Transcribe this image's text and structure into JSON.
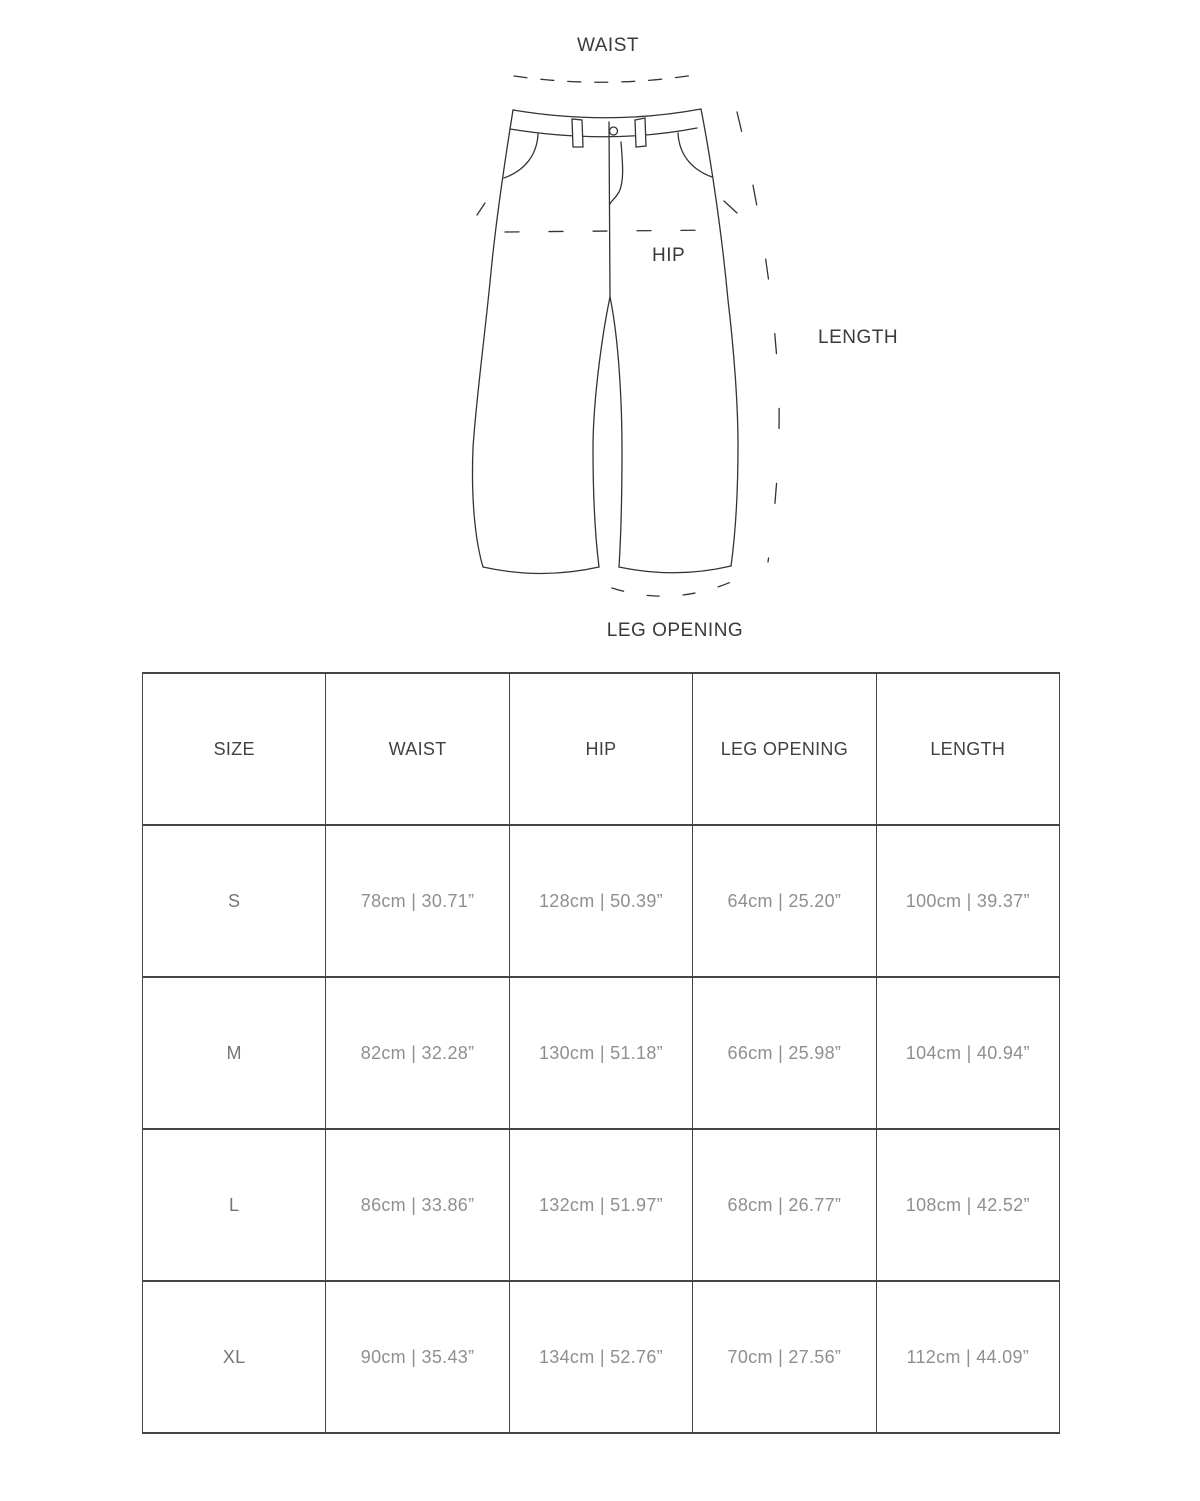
{
  "diagram": {
    "labels": {
      "waist": "WAIST",
      "hip": "HIP",
      "length": "LENGTH",
      "leg_opening": "LEG OPENING"
    }
  },
  "table": {
    "headers": [
      "SIZE",
      "WAIST",
      "HIP",
      "LEG OPENING",
      "LENGTH"
    ],
    "rows": [
      {
        "size": "S",
        "waist": "78cm | 30.71”",
        "hip": "128cm | 50.39”",
        "leg_opening": "64cm | 25.20”",
        "length": "100cm | 39.37”"
      },
      {
        "size": "M",
        "waist": "82cm | 32.28”",
        "hip": "130cm | 51.18”",
        "leg_opening": "66cm | 25.98”",
        "length": "104cm | 40.94”"
      },
      {
        "size": "L",
        "waist": "86cm | 33.86”",
        "hip": "132cm | 51.97”",
        "leg_opening": "68cm | 26.77”",
        "length": "108cm | 42.52”"
      },
      {
        "size": "XL",
        "waist": "90cm | 35.43”",
        "hip": "134cm | 52.76”",
        "leg_opening": "70cm | 27.56”",
        "length": "112cm | 44.09”"
      }
    ]
  },
  "colors": {
    "background": "#ffffff",
    "line_ink": "#333333",
    "table_border": "#454545",
    "header_text": "#414141",
    "value_text": "#8f8f8f",
    "label_text": "#3a3a3a"
  }
}
